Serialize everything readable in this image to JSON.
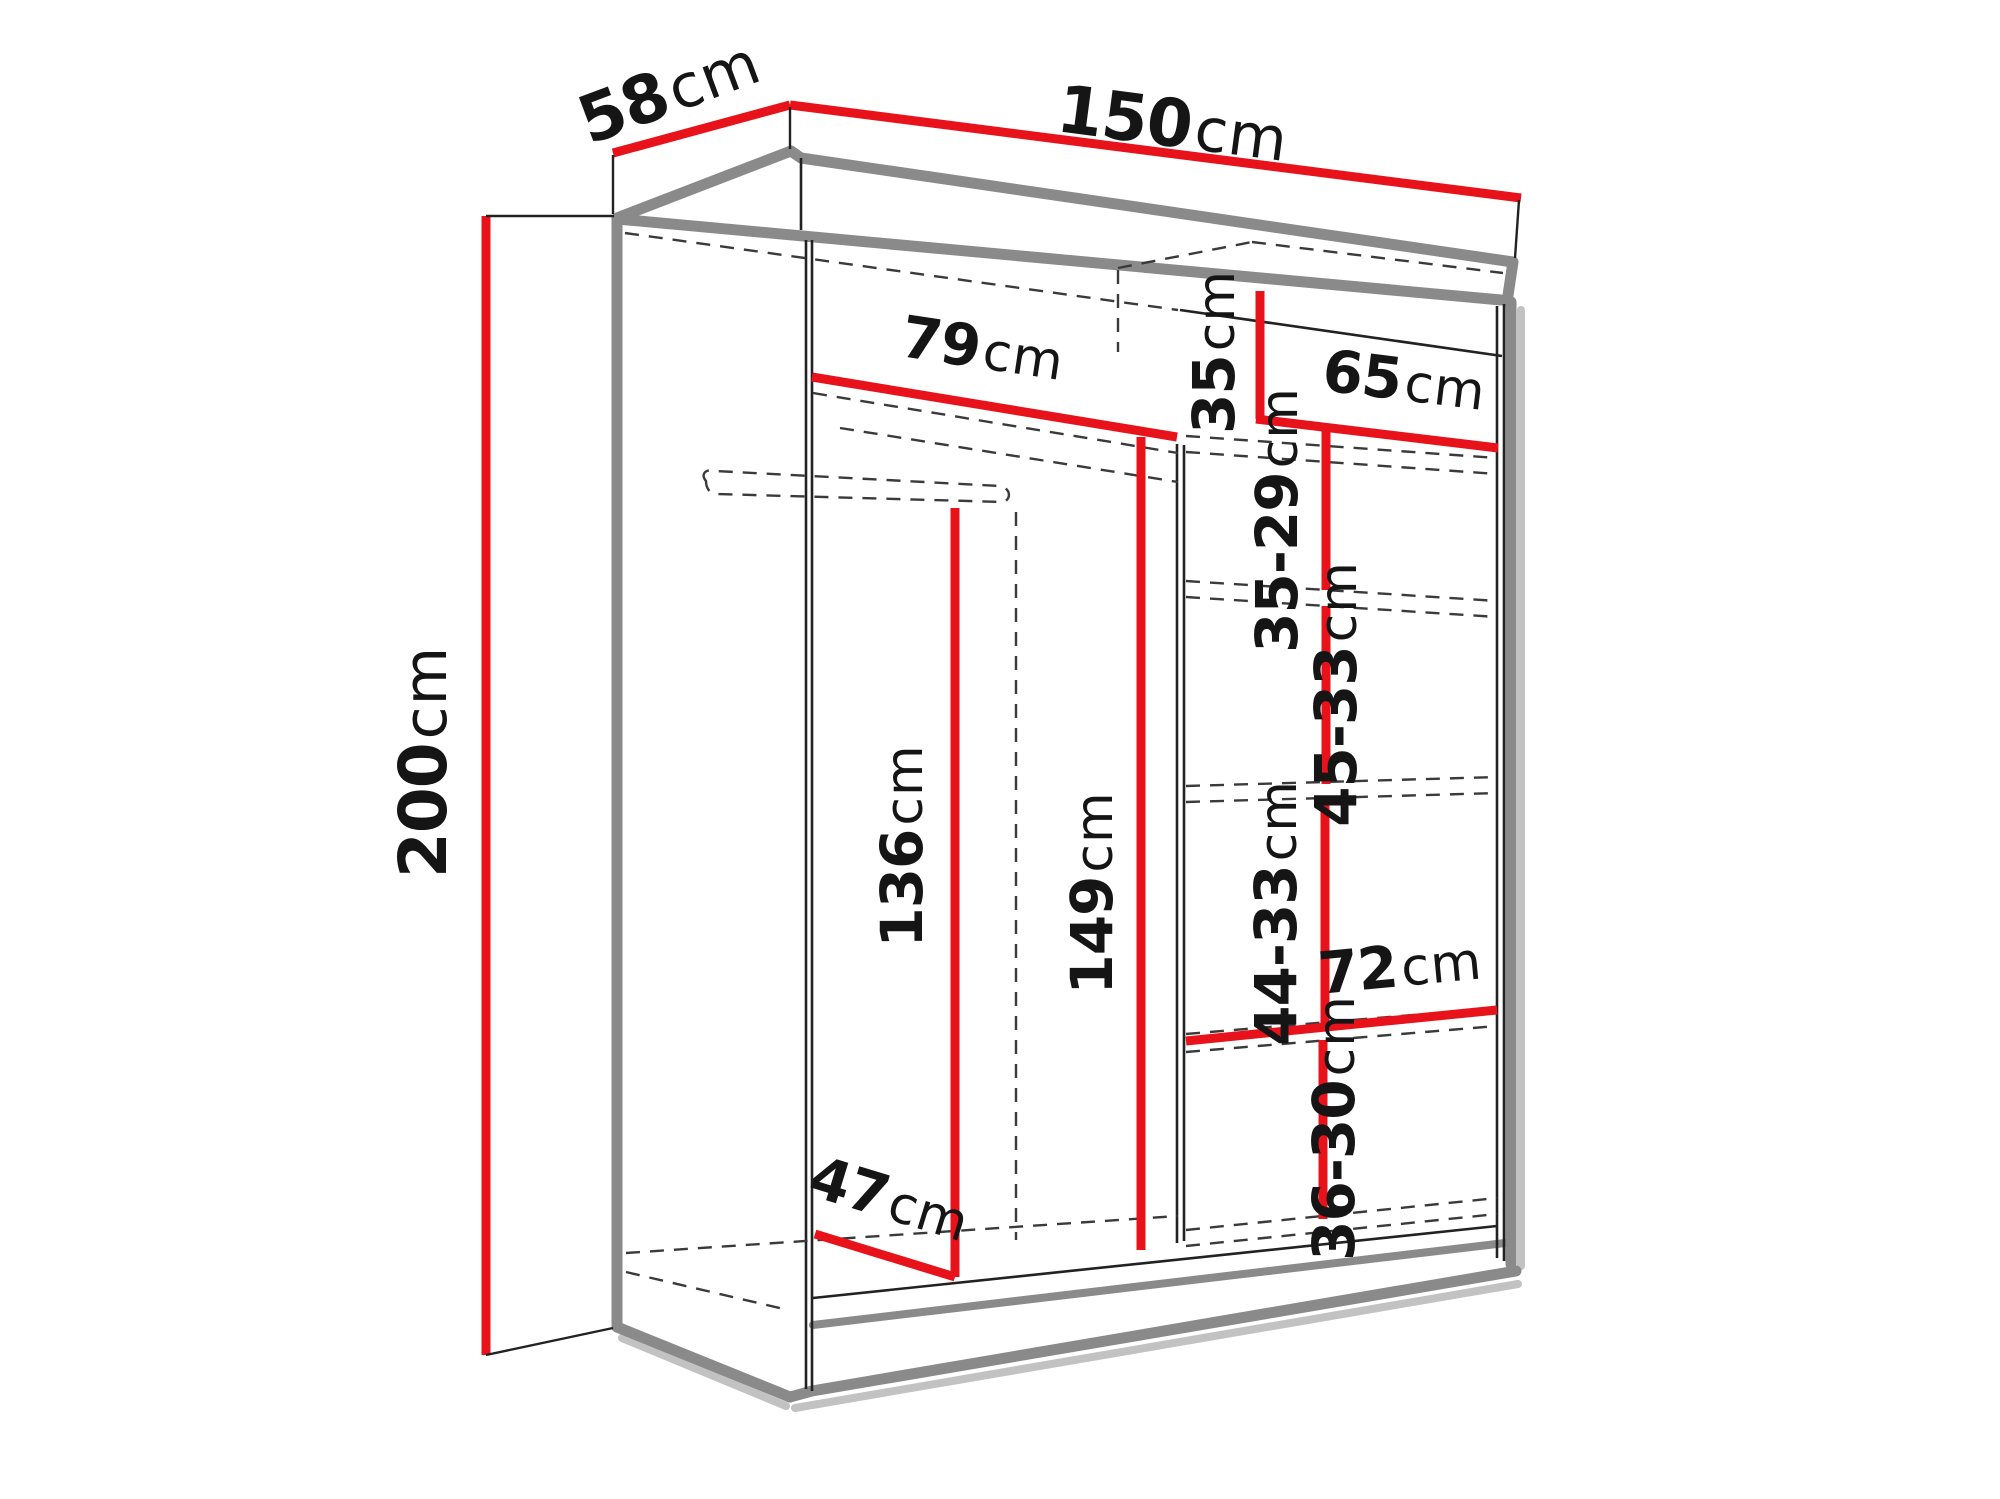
{
  "title": "Wardrobe dimension diagram",
  "unit": "cm",
  "colors": {
    "dimension_line": "#e8121a",
    "edge_grey": "#8a8a8a",
    "shadow_grey": "#c2c2c2",
    "line_black": "#222222",
    "text": "#151515",
    "background": "#ffffff"
  },
  "wardrobe": {
    "overall": {
      "depth": {
        "value": "58",
        "unit": "cm"
      },
      "width": {
        "value": "150",
        "unit": "cm"
      },
      "height": {
        "value": "200",
        "unit": "cm"
      }
    },
    "interior": {
      "left_section_width": {
        "value": "79",
        "unit": "cm"
      },
      "top_shelf_height": {
        "value": "35",
        "unit": "cm"
      },
      "right_section_width": {
        "value": "65",
        "unit": "cm"
      },
      "right_shelf_spacing_1": {
        "value": "35-29",
        "unit": "cm"
      },
      "right_shelf_spacing_2": {
        "value": "45-33",
        "unit": "cm"
      },
      "right_shelf_spacing_3": {
        "value": "44-33",
        "unit": "cm"
      },
      "right_bottom_width": {
        "value": "72",
        "unit": "cm"
      },
      "right_shelf_spacing_4": {
        "value": "36-30",
        "unit": "cm"
      },
      "hanging_space_height": {
        "value": "136",
        "unit": "cm"
      },
      "center_clear_height": {
        "value": "149",
        "unit": "cm"
      },
      "interior_depth": {
        "value": "47",
        "unit": "cm"
      }
    }
  }
}
